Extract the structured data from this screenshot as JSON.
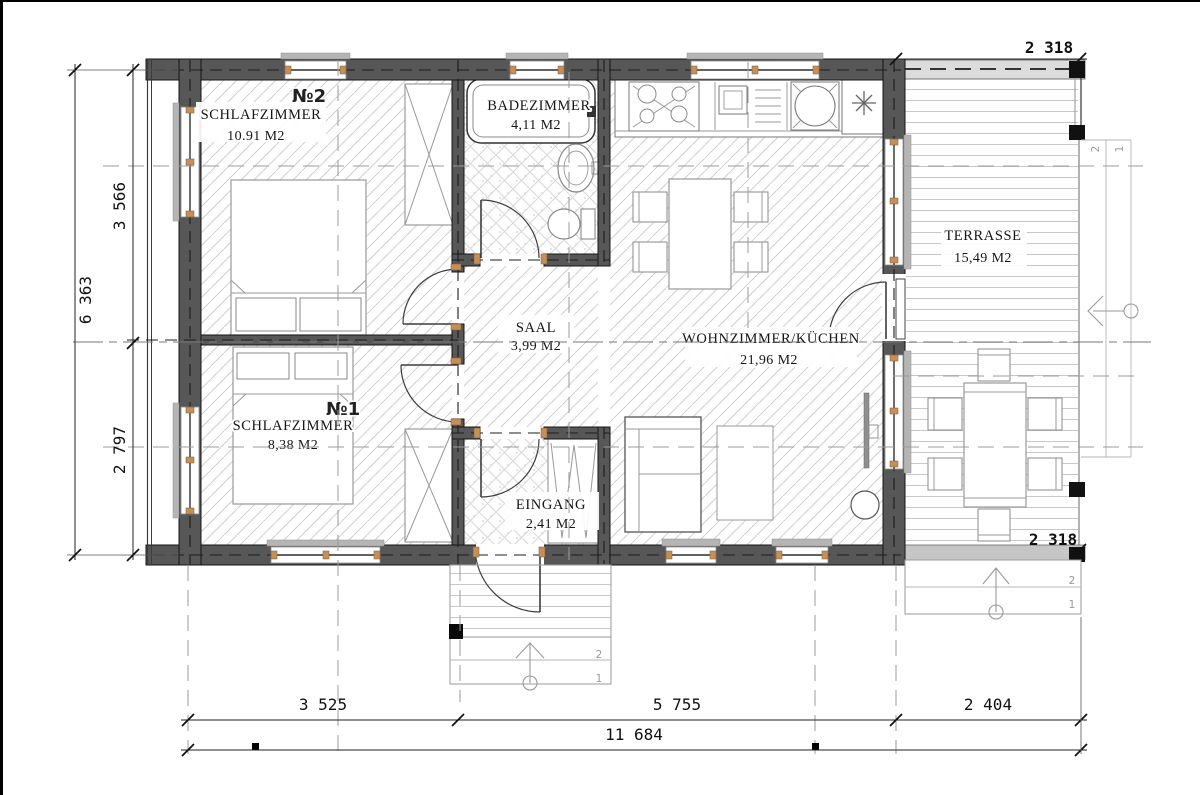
{
  "rooms": {
    "schlafzimmer2": {
      "number": "№2",
      "name": "SCHLAFZIMMER",
      "area": "10.91 M2"
    },
    "badezimmer": {
      "name": "BADEZIMMER",
      "area": "4,11 M2"
    },
    "wohnzimmer": {
      "name": "WOHNZIMMER/KÜCHEN",
      "area": "21,96 M2"
    },
    "terrasse": {
      "name": "TERRASSE",
      "area": "15,49 M2"
    },
    "saal": {
      "name": "SAAL",
      "area": "3,99 M2"
    },
    "schlafzimmer1": {
      "number": "№1",
      "name": "SCHLAFZIMMER",
      "area": "8,38 M2"
    },
    "eingang": {
      "name": "EINGANG",
      "area": "2,41 M2"
    }
  },
  "dimensions": {
    "left_total": "6 363",
    "left_upper": "3 566",
    "left_lower": "2 797",
    "bottom_seg1": "3 525",
    "bottom_seg2": "5 755",
    "bottom_seg3": "2 404",
    "bottom_total": "11 684",
    "terrace_top": "2 318",
    "terrace_bottom": "2 318"
  },
  "stairs": {
    "front": {
      "step2": "2",
      "step1": "1"
    },
    "side": {
      "step2": "2",
      "step1": "1"
    },
    "terrace": {
      "step2": "2",
      "step1": "1"
    }
  },
  "colors": {
    "wall": "#575757",
    "window_block": "#c49058",
    "hatch_line": "#cfcfcf",
    "deck_line": "#c8c8c8",
    "dim_text": "#111111"
  }
}
